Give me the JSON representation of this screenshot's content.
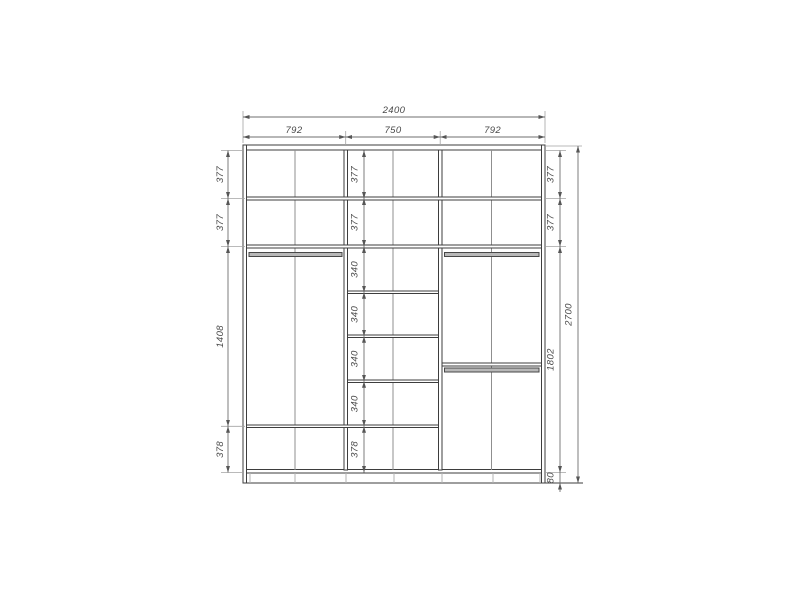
{
  "dimensions": {
    "total_width": "2400",
    "section_widths": [
      "792",
      "750",
      "792"
    ],
    "total_height": "2700",
    "left_column": [
      "377",
      "377",
      "1408",
      "378"
    ],
    "center_column": [
      "377",
      "377",
      "340",
      "340",
      "340",
      "340",
      "378"
    ],
    "right_column": [
      "377",
      "377",
      "1802",
      "80"
    ]
  },
  "colors": {
    "background": "#ffffff",
    "structure_line": "#3d3d3d",
    "dimension_line": "#6f6f6f",
    "dimension_text": "#4a4a4a",
    "rod_fill": "#b8b8b8"
  }
}
